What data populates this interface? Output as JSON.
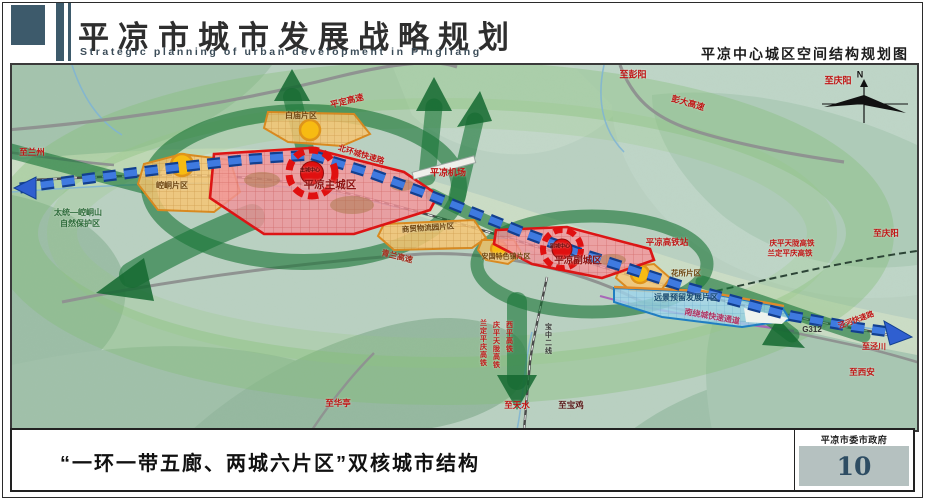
{
  "header": {
    "title_cn": "平凉市城市发展战略规划",
    "title_en": "Strategic planning of urban development in Pingliang",
    "subtitle_right": "平凉中心城区空间结构规划图"
  },
  "footer": {
    "caption": "“一环一带五廊、两城六片区”双核城市结构",
    "authority": "平凉市委市政府",
    "page_number": "10"
  },
  "colors": {
    "accent_slate": "#3d5a6b",
    "corridor_green": "#1d7a3c",
    "axis_blue": "#2f5fd0",
    "zone_red": "#dd1414",
    "zone_orange": "#d98a20",
    "reserve_blue": "#1f7ec2"
  },
  "map": {
    "labels": [
      {
        "name": "label-to-pengyang",
        "text": "至彭阳",
        "x": 623,
        "y": 12,
        "size": 9,
        "color": "#c01414"
      },
      {
        "name": "label-to-qingyang-top",
        "text": "至庆阳",
        "x": 828,
        "y": 18,
        "size": 9,
        "color": "#c01414"
      },
      {
        "name": "label-pengda-expressway",
        "text": "彭大高速",
        "x": 678,
        "y": 40,
        "size": 8.5,
        "color": "#c01414",
        "rotate": 16
      },
      {
        "name": "label-pingding-expressway",
        "text": "平定高速",
        "x": 337,
        "y": 38,
        "size": 8.5,
        "color": "#c01414",
        "rotate": -14
      },
      {
        "name": "label-north-ring-road",
        "text": "北环城快速路",
        "x": 351,
        "y": 92,
        "size": 8,
        "color": "#c01414",
        "rotate": 17
      },
      {
        "name": "label-pingliang-airport",
        "text": "平凉机场",
        "x": 438,
        "y": 110,
        "size": 9,
        "color": "#c01414"
      },
      {
        "name": "label-main-city",
        "text": "平凉主城区",
        "x": 320,
        "y": 122,
        "size": 10.5,
        "color": "#8f1212"
      },
      {
        "name": "label-main-core",
        "text": "主城中心",
        "x": 300,
        "y": 108,
        "size": 5,
        "color": "#5f0808"
      },
      {
        "name": "label-sub-city",
        "text": "平凉副城区",
        "x": 568,
        "y": 198,
        "size": 9.5,
        "color": "#8f1212"
      },
      {
        "name": "label-sub-core",
        "text": "副城中心",
        "x": 550,
        "y": 184,
        "size": 5,
        "color": "#5f0808"
      },
      {
        "name": "label-kongtong-district",
        "text": "崆峒片区",
        "x": 162,
        "y": 123,
        "size": 8,
        "color": "#6e4510"
      },
      {
        "name": "label-baimiao-district",
        "text": "白庙片区",
        "x": 291,
        "y": 53,
        "size": 8,
        "color": "#6e4510"
      },
      {
        "name": "label-logistics-district",
        "text": "商贸物流园片区",
        "x": 418,
        "y": 165,
        "size": 7.5,
        "color": "#6e4510",
        "rotate": -4
      },
      {
        "name": "label-town-district",
        "text": "安国特色镇片区",
        "x": 496,
        "y": 194,
        "size": 7,
        "color": "#6e4510"
      },
      {
        "name": "label-huasuo-district",
        "text": "花所片区",
        "x": 676,
        "y": 210,
        "size": 7.5,
        "color": "#6e4510"
      },
      {
        "name": "label-reserve-district",
        "text": "远景预留发展片区",
        "x": 676,
        "y": 235,
        "size": 8,
        "color": "#15486e"
      },
      {
        "name": "label-hsr-station",
        "text": "平凉高铁站",
        "x": 657,
        "y": 179,
        "size": 8.5,
        "color": "#c01414"
      },
      {
        "name": "label-qptl-hsr",
        "text": "庆平天陇高铁",
        "x": 782,
        "y": 180,
        "size": 7.5,
        "color": "#c01414"
      },
      {
        "name": "label-ldpq-hsr",
        "text": "兰定平庆高铁",
        "x": 780,
        "y": 190,
        "size": 7.5,
        "color": "#c01414"
      },
      {
        "name": "label-to-qingyang-right",
        "text": "至庆阳",
        "x": 876,
        "y": 170,
        "size": 8.5,
        "color": "#c01414"
      },
      {
        "name": "label-qinglan-expressway",
        "text": "青兰高速",
        "x": 387,
        "y": 194,
        "size": 8,
        "color": "#a22a1a",
        "rotate": 14
      },
      {
        "name": "label-south-bypass",
        "text": "南绕城快速通道",
        "x": 702,
        "y": 254,
        "size": 8,
        "color": "#b03262",
        "rotate": 10
      },
      {
        "name": "label-g312",
        "text": "G312",
        "x": 802,
        "y": 267,
        "size": 8,
        "color": "#333333"
      },
      {
        "name": "label-jinghe-expressway",
        "text": "泾河快速路",
        "x": 846,
        "y": 257,
        "size": 7.5,
        "color": "#c01414",
        "rotate": -20
      },
      {
        "name": "label-to-xian",
        "text": "至西安",
        "x": 852,
        "y": 309,
        "size": 8.5,
        "color": "#c01414"
      },
      {
        "name": "label-to-jingchuan",
        "text": "至泾川",
        "x": 864,
        "y": 284,
        "size": 8,
        "color": "#c01414"
      },
      {
        "name": "label-rail-ldpq-vertical",
        "text": "兰定平庆高铁",
        "x": 473,
        "y": 280,
        "size": 7,
        "color": "#c01414",
        "vertical": true
      },
      {
        "name": "label-rail-qptl-vertical",
        "text": "庆平天陇高铁",
        "x": 486,
        "y": 282,
        "size": 7,
        "color": "#c01414",
        "vertical": true
      },
      {
        "name": "label-rail-xiping-vertical",
        "text": "西平高铁",
        "x": 499,
        "y": 274,
        "size": 7,
        "color": "#c01414",
        "vertical": true
      },
      {
        "name": "label-rail-baozhong-vertical",
        "text": "宝中二线",
        "x": 538,
        "y": 276,
        "size": 7,
        "color": "#3a3a3a",
        "vertical": true
      },
      {
        "name": "label-to-tianshui",
        "text": "至天水",
        "x": 507,
        "y": 342,
        "size": 8.5,
        "color": "#c01414"
      },
      {
        "name": "label-to-baoji",
        "text": "至宝鸡",
        "x": 561,
        "y": 342,
        "size": 8.5,
        "color": "#5a1a1a"
      },
      {
        "name": "label-to-huating",
        "text": "至华亭",
        "x": 328,
        "y": 340,
        "size": 8.5,
        "color": "#c01414"
      },
      {
        "name": "label-nature-reserve-line1",
        "text": "太统—崆峒山",
        "x": 68,
        "y": 150,
        "size": 8,
        "color": "#2d6b3a"
      },
      {
        "name": "label-nature-reserve-line2",
        "text": "自然保护区",
        "x": 70,
        "y": 161,
        "size": 8,
        "color": "#2d6b3a"
      },
      {
        "name": "label-to-lanzhou",
        "text": "至兰州",
        "x": 22,
        "y": 89,
        "size": 8.5,
        "color": "#c01414"
      },
      {
        "name": "label-compass-n",
        "text": "N",
        "x": 850,
        "y": 12,
        "size": 9,
        "color": "#111111"
      }
    ]
  }
}
